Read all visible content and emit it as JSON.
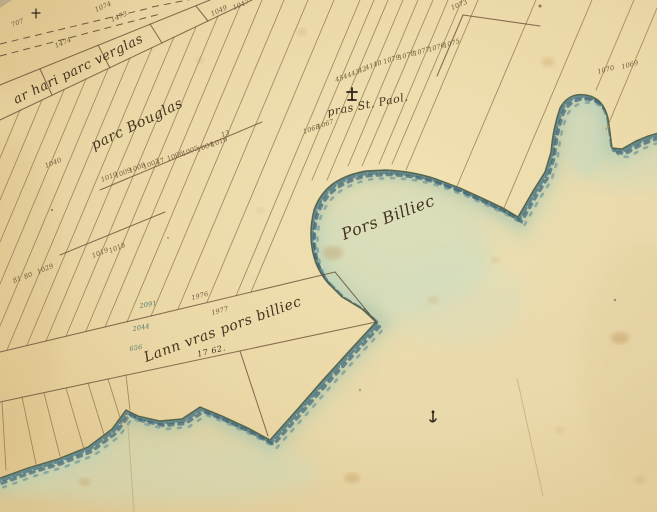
{
  "map": {
    "description": "Hand-drawn 19th-century cadastral shoreline map (Brittany), sepia ink on aged paper with blue-green coastal wash",
    "water_body_label": "Pors Billiec"
  },
  "labels": {
    "place_labels": [
      {
        "id": "label-verglas",
        "t": "ar hari parc verglas",
        "x": 16,
        "y": 104,
        "r": -26,
        "s": 13
      },
      {
        "id": "label-parc-bouglas",
        "t": "parc Bouglas",
        "x": 94,
        "y": 150,
        "r": -26,
        "s": 14
      },
      {
        "id": "label-pras-st-paol",
        "t": "pras St. Paol.",
        "x": 328,
        "y": 116,
        "r": -11,
        "s": 11
      },
      {
        "id": "label-pors-billiec",
        "t": "Pors Billiec",
        "x": 344,
        "y": 240,
        "r": -21,
        "s": 16
      },
      {
        "id": "label-lann-pors-billiec",
        "t": "Lann vras pors billiec",
        "x": 146,
        "y": 362,
        "r": -20,
        "s": 14
      },
      {
        "id": "label-area-number",
        "t": "17 62.",
        "x": 198,
        "y": 357,
        "r": -14,
        "s": 8
      }
    ],
    "parcel_numbers": [
      {
        "t": "707",
        "x": 12,
        "y": 27,
        "r": -20
      },
      {
        "t": "1074",
        "x": 96,
        "y": 12,
        "r": -24
      },
      {
        "t": "1473",
        "x": 112,
        "y": 22,
        "r": -24
      },
      {
        "t": "1474",
        "x": 56,
        "y": 48,
        "r": -24
      },
      {
        "t": "1049",
        "x": 212,
        "y": 16,
        "r": -24
      },
      {
        "t": "1047",
        "x": 234,
        "y": 10,
        "r": -24
      },
      {
        "t": "45",
        "x": 336,
        "y": 82,
        "r": -18
      },
      {
        "t": "44",
        "x": 344,
        "y": 79,
        "r": -18
      },
      {
        "t": "43",
        "x": 352,
        "y": 76,
        "r": -18
      },
      {
        "t": "42",
        "x": 359,
        "y": 73,
        "r": -18
      },
      {
        "t": "41",
        "x": 366,
        "y": 70,
        "r": -18
      },
      {
        "t": "40",
        "x": 374,
        "y": 67,
        "r": -18
      },
      {
        "t": "1079",
        "x": 384,
        "y": 64,
        "r": -18
      },
      {
        "t": "1078",
        "x": 399,
        "y": 60,
        "r": -18
      },
      {
        "t": "1077",
        "x": 414,
        "y": 56,
        "r": -18
      },
      {
        "t": "1076",
        "x": 429,
        "y": 52,
        "r": -18
      },
      {
        "t": "1075",
        "x": 444,
        "y": 48,
        "r": -18
      },
      {
        "t": "1073",
        "x": 452,
        "y": 10,
        "r": -22
      },
      {
        "t": "1070",
        "x": 598,
        "y": 74,
        "r": -15
      },
      {
        "t": "1069",
        "x": 622,
        "y": 69,
        "r": -15
      },
      {
        "t": "1068",
        "x": 304,
        "y": 134,
        "r": -20
      },
      {
        "t": "1067",
        "x": 318,
        "y": 129,
        "r": -20
      },
      {
        "t": "1010",
        "x": 102,
        "y": 182,
        "r": -22
      },
      {
        "t": "1009",
        "x": 116,
        "y": 178,
        "r": -22
      },
      {
        "t": "1008",
        "x": 130,
        "y": 173,
        "r": -22
      },
      {
        "t": "1007",
        "x": 144,
        "y": 169,
        "r": -22
      },
      {
        "t": "47",
        "x": 157,
        "y": 165,
        "r": -22
      },
      {
        "t": "1006",
        "x": 168,
        "y": 161,
        "r": -22
      },
      {
        "t": "1005",
        "x": 183,
        "y": 156,
        "r": -22
      },
      {
        "t": "1004",
        "x": 198,
        "y": 152,
        "r": -22
      },
      {
        "t": "1016",
        "x": 212,
        "y": 147,
        "r": -22
      },
      {
        "t": "13",
        "x": 222,
        "y": 137,
        "r": -20
      },
      {
        "t": "1040",
        "x": 46,
        "y": 168,
        "r": -22
      },
      {
        "t": "1019",
        "x": 93,
        "y": 258,
        "r": -22
      },
      {
        "t": "1018",
        "x": 110,
        "y": 253,
        "r": -22
      },
      {
        "t": "81",
        "x": 14,
        "y": 283,
        "r": -22
      },
      {
        "t": "80",
        "x": 25,
        "y": 279,
        "r": -22
      },
      {
        "t": "1029",
        "x": 38,
        "y": 274,
        "r": -22
      },
      {
        "t": "1976",
        "x": 192,
        "y": 300,
        "r": -15
      },
      {
        "t": "1977",
        "x": 212,
        "y": 315,
        "r": -15
      },
      {
        "t": "2091",
        "x": 140,
        "y": 308,
        "r": -10,
        "c": "teal-number"
      },
      {
        "t": "2044",
        "x": 133,
        "y": 331,
        "r": -10,
        "c": "teal-number"
      },
      {
        "t": "656",
        "x": 130,
        "y": 351,
        "r": -10,
        "c": "teal-number"
      }
    ]
  },
  "map_geometry": {
    "coast_path_d": "M -8 481 L 28 468 L 58 459 L 88 447 L 112 429 L 126 410 L 138 416 L 160 421 L 182 419 L 200 407 L 222 416 L 248 428 L 270 440 L 295 412 L 322 381 L 352 348 L 376 322 L 362 309 L 342 297 L 328 283 Q 315 268 312 248 Q 309 230 314 210 Q 320 193 334 183 Q 348 174 366 171 L 385 170 Q 412 171 436 179 L 460 188 L 482 198 L 503 208 L 518 217 L 533 191 L 545 172 L 551 152 Q 553 128 560 108 Q 566 97 576 95 Q 588 93 598 100 Q 605 106 608 118 L 610 132 L 612 148 L 622 149 L 636 141 L 648 136 L 662 132",
    "sea_path_d": "M -8 481 L 28 468 L 58 459 L 88 447 L 112 429 L 126 410 L 138 416 L 160 421 L 182 419 L 200 407 L 222 416 L 248 428 L 270 440 L 295 412 L 322 381 L 352 348 L 376 322 L 362 309 L 342 297 L 328 283 Q 315 268 312 248 Q 309 230 314 210 Q 320 193 334 183 Q 348 174 366 171 L 385 170 Q 412 171 436 179 L 460 188 L 482 198 L 503 208 L 518 217 L 533 191 L 545 172 L 551 152 Q 553 128 560 108 Q 566 97 576 95 Q 588 93 598 100 Q 605 106 608 118 L 610 132 L 612 148 L 622 149 L 636 141 L 648 136 L 662 132 L 662 520 L -8 520 Z",
    "parcel_lines": [
      [
        20,
        110,
        0,
        158
      ],
      [
        42,
        100,
        0,
        200
      ],
      [
        64,
        90,
        0,
        242
      ],
      [
        86,
        79,
        0,
        284
      ],
      [
        108,
        69,
        0,
        326
      ],
      [
        130,
        58,
        7,
        350
      ],
      [
        152,
        48,
        27,
        345
      ],
      [
        174,
        37,
        46,
        341
      ],
      [
        196,
        27,
        66,
        336
      ],
      [
        218,
        16,
        86,
        331
      ],
      [
        240,
        6,
        105,
        327
      ],
      [
        262,
        0,
        127,
        322
      ],
      [
        284,
        0,
        151,
        316
      ],
      [
        308,
        0,
        178,
        309
      ],
      [
        334,
        0,
        207,
        302
      ],
      [
        360,
        0,
        236,
        296
      ],
      [
        374,
        0,
        251,
        292
      ],
      [
        388,
        0,
        312,
        180
      ],
      [
        403,
        0,
        327,
        180
      ],
      [
        418,
        0,
        348,
        166
      ],
      [
        433,
        0,
        362,
        166
      ],
      [
        448,
        0,
        379,
        164
      ],
      [
        462,
        0,
        392,
        164
      ],
      [
        478,
        0,
        406,
        170
      ],
      [
        536,
        0,
        457,
        186
      ],
      [
        592,
        0,
        504,
        208
      ],
      [
        634,
        0,
        596,
        90
      ],
      [
        657,
        8,
        606,
        130
      ],
      [
        2,
        402,
        6,
        470
      ],
      [
        22,
        397,
        36,
        464
      ],
      [
        44,
        393,
        60,
        456
      ],
      [
        66,
        388,
        84,
        449
      ],
      [
        88,
        383,
        106,
        441
      ],
      [
        108,
        379,
        122,
        424
      ],
      [
        126,
        375,
        130,
        410
      ]
    ],
    "boundary_lines": [
      [
        0,
        85,
        210,
        0
      ],
      [
        0,
        120,
        252,
        0
      ],
      [
        40,
        69,
        52,
        95
      ],
      [
        98,
        45,
        110,
        68
      ],
      [
        150,
        24,
        162,
        43
      ],
      [
        196,
        6,
        208,
        21
      ],
      [
        100,
        190,
        262,
        122
      ],
      [
        60,
        255,
        165,
        212
      ],
      [
        0,
        352,
        335,
        272
      ],
      [
        335,
        272,
        376,
        322
      ],
      [
        0,
        402,
        376,
        322
      ],
      [
        240,
        351,
        268,
        436
      ],
      [
        437,
        76,
        463,
        15
      ],
      [
        463,
        15,
        540,
        26
      ]
    ],
    "road_lines": [
      [
        0,
        44,
        150,
        8
      ],
      [
        0,
        56,
        160,
        14
      ],
      [
        152,
        7,
        218,
        -6
      ]
    ]
  },
  "colors": {
    "paper": "#e9d6a4",
    "paper_light": "#f1e2b4",
    "paper_dark": "#dcc189",
    "ink": "#6a5136",
    "handwriting": "#44331f",
    "shore_ink": "#4f5c42",
    "stipple_blue": "#46707f",
    "water_wash": "#c8dcc0",
    "stain": "#b98f55"
  }
}
